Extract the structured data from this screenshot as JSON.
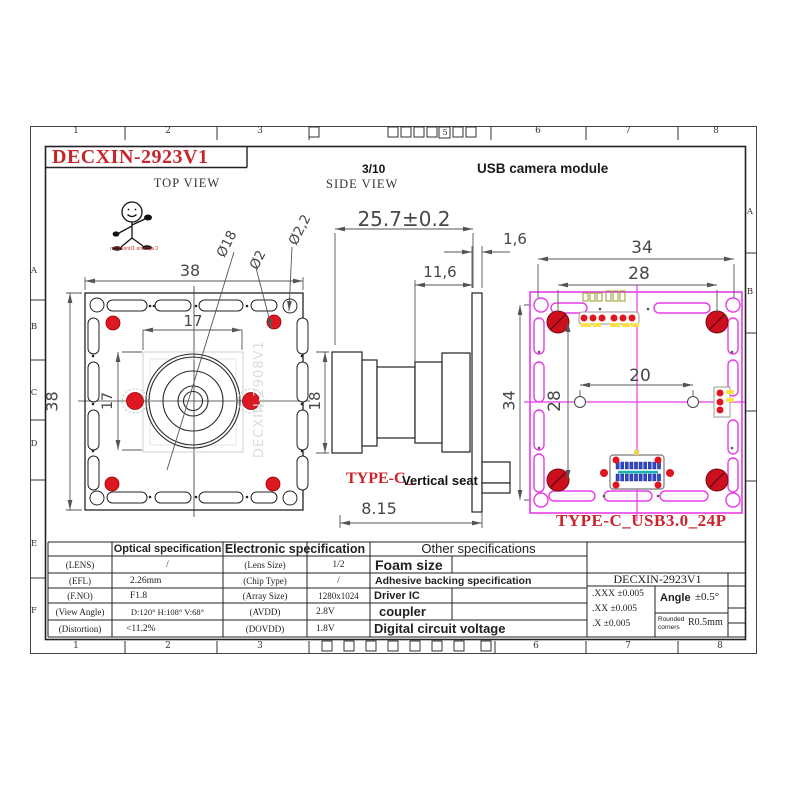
{
  "colors": {
    "accent_red": "#c9252c",
    "magenta": "#e83ce8",
    "dot_red": "#dd1822",
    "pin_blue": "#2f49c9",
    "corner_red": "#cc0f1f"
  },
  "sheet": {
    "top_numbers": [
      "1",
      "2",
      "3",
      "5",
      "6",
      "7",
      "8"
    ],
    "bottom_numbers": [
      "1",
      "2",
      "3",
      "6",
      "7",
      "8"
    ],
    "left_letters": [
      "A",
      "B",
      "C",
      "D",
      "E",
      "F"
    ],
    "right_letters": [
      "A",
      "B"
    ],
    "title": "DECXIN-2923V1",
    "product": "USB camera module",
    "page_note": "3/10"
  },
  "mascot": {
    "caption": "Capture Direction"
  },
  "top_view": {
    "label": "TOP VIEW",
    "watermark": "DECXIN-2908V1",
    "dims": {
      "width": "38",
      "height": "38",
      "pitch_h": "17",
      "pitch_v": "17",
      "lens_dia": "Ø18",
      "hole_dia": "Ø2",
      "corner_hole_dia": "Ø2,2"
    }
  },
  "side_view": {
    "label": "SIDE VIEW",
    "dims": {
      "overall_len": "25.7±0.2",
      "pcb_thickness": "1,6",
      "barrel_len": "11,6",
      "lens_height": "18",
      "board_height": "34",
      "seat_len": "8.15"
    },
    "connector_note_red": "TYPE-C_",
    "connector_note": "Vertical seat"
  },
  "back_view": {
    "label": "TYPE-C_USB3.0_24P",
    "dims": {
      "width": "34",
      "hole_pitch_w": "28",
      "center_pitch": "20",
      "hole_pitch_h": "28"
    }
  },
  "spec_table": {
    "optical_header": "Optical specification",
    "electronic_header": "Electronic specification",
    "other_header": "Other specifications",
    "optical_rows": [
      {
        "label": "(LENS)",
        "value": "/"
      },
      {
        "label": "(EFL)",
        "value": "2.26mm"
      },
      {
        "label": "(F.NO)",
        "value": "F1.8"
      },
      {
        "label": "(View Angle)",
        "value": "D:120°  H:108°  V:68°"
      },
      {
        "label": "(Distortion)",
        "value": "<11.2%"
      }
    ],
    "electronic_rows": [
      {
        "label": "(Lens Size)",
        "value": "1/2"
      },
      {
        "label": "(Chip Type)",
        "value": "/"
      },
      {
        "label": "(Array Size)",
        "value": "1280x1024"
      },
      {
        "label": "(AVDD)",
        "value": "2.8V"
      },
      {
        "label": "(DOVDD)",
        "value": "1.8V"
      }
    ],
    "other_rows": [
      "Foam size",
      "Adhesive backing specification",
      "Driver IC",
      "coupler",
      "Digital circuit voltage"
    ],
    "title_block": {
      "part_number": "DECXIN-2923V1",
      "tolerances": [
        ".XXX ±0.005",
        ".XX ±0.005",
        ".X ±0.005"
      ],
      "angle_label": "Angle",
      "angle_value": "±0.5°",
      "rounded_label": "Rounded corners",
      "rounded_value": "R0.5mm"
    }
  }
}
